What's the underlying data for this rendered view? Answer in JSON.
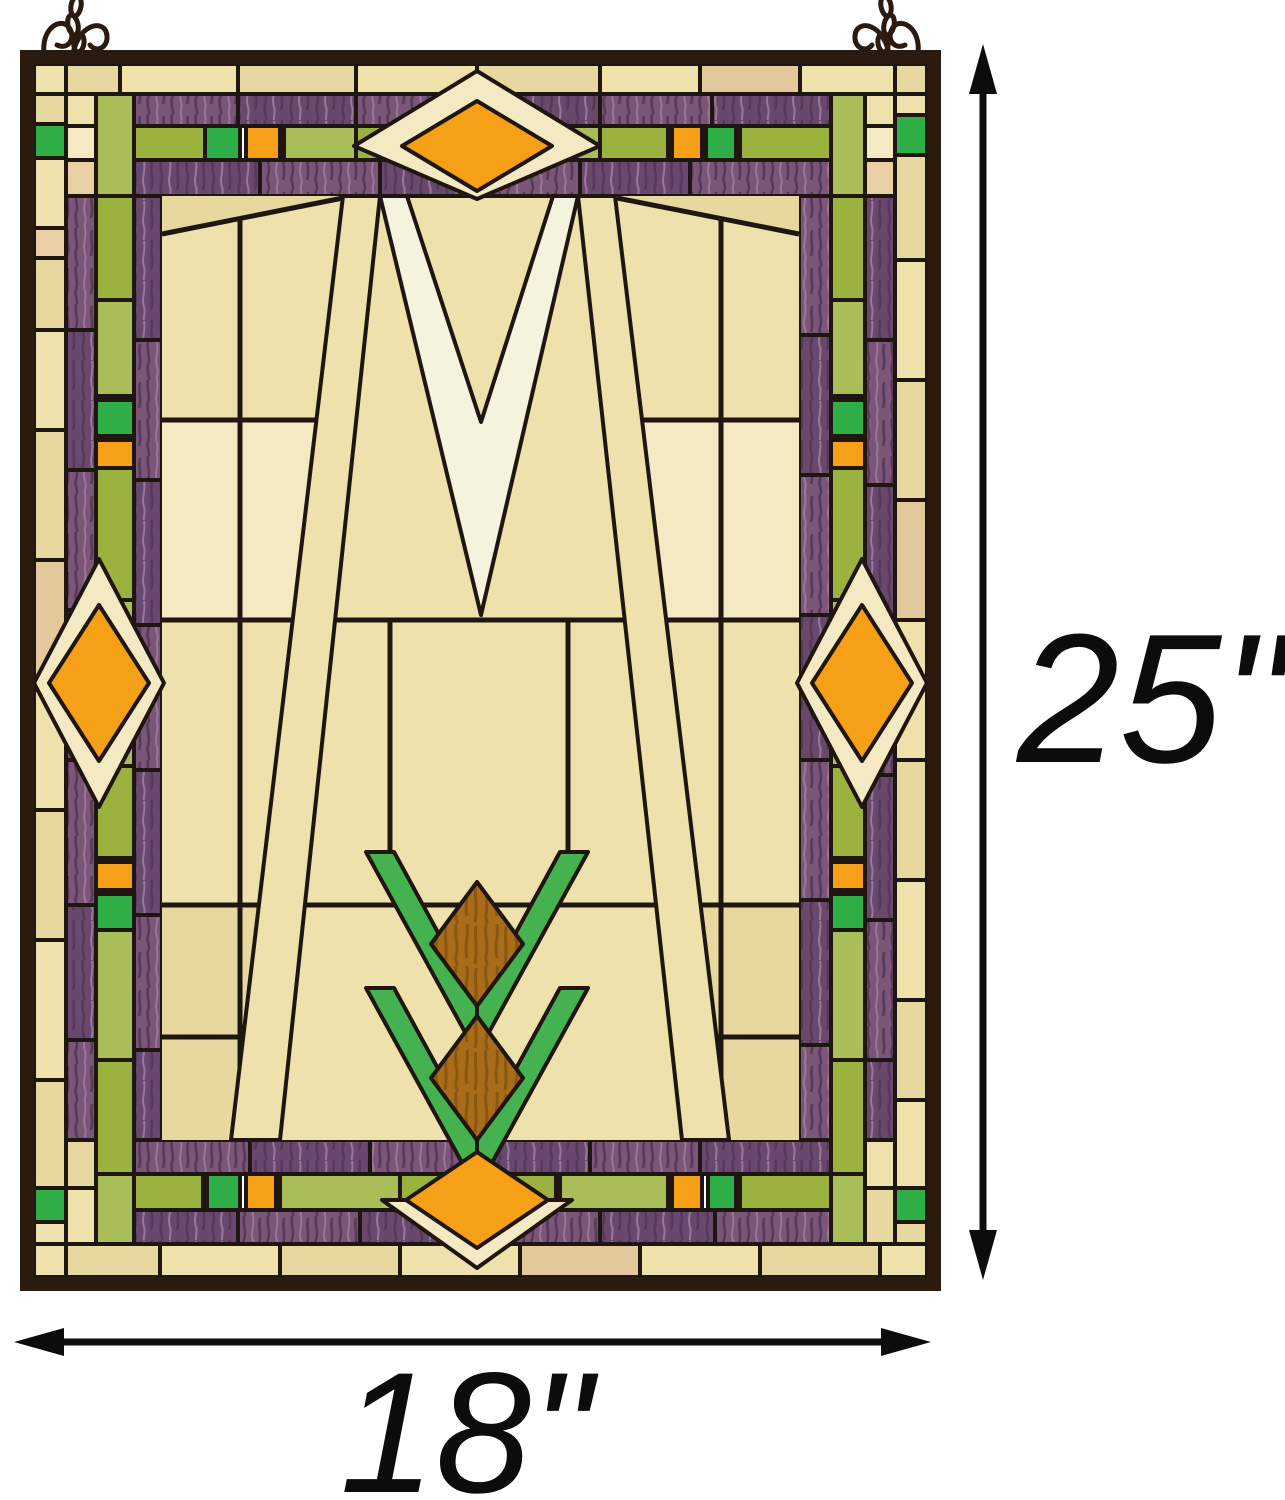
{
  "annotations": {
    "height_label": "25\"",
    "width_label": "18\""
  },
  "colors": {
    "background": "#ffffff",
    "frame": "#2a1a10",
    "lead": "#201611",
    "cream1": "#eee1ac",
    "cream2": "#e7d8a0",
    "cream3": "#f3e9c2",
    "tan": "#e3c89c",
    "peach": "#eacfa5",
    "white": "#f5f2de",
    "purpleA": "#7b5677",
    "purpleB": "#68486c",
    "purpleStreakDark": "#54395b",
    "purpleStreakLight": "#98789b",
    "oliveA": "#9cb23f",
    "oliveB": "#a9bd58",
    "brightGreen": "#2fae47",
    "wheatGreen": "#45b250",
    "orange": "#f5a017",
    "amber": "#a96d19",
    "amberStreak": "#8a5712",
    "ink": "#0c0c0c"
  }
}
